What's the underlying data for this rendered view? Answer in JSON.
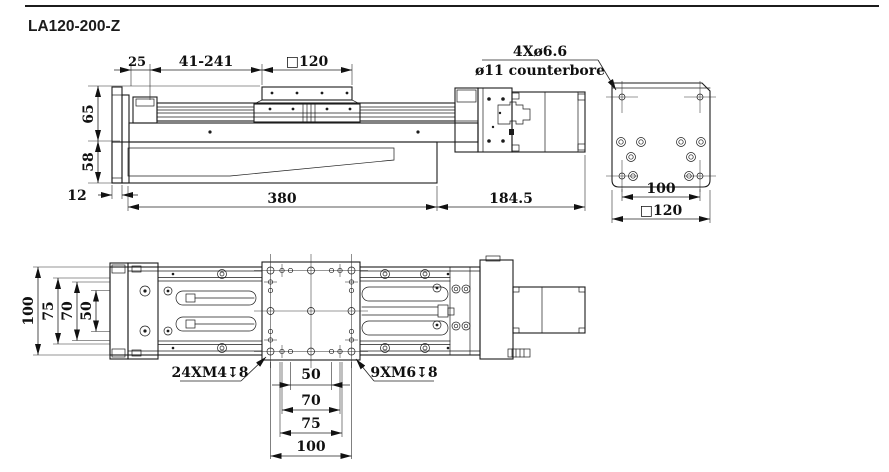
{
  "title": "LA120-200-Z",
  "front": {
    "d25": "25",
    "dstroke": "41-241",
    "dcarriage": "□120",
    "d65": "65",
    "d58": "58",
    "d12": "12",
    "d380": "380",
    "d1845": "184.5",
    "callout1": "4Xø6.6",
    "callout2": "ø11 counterbore"
  },
  "end": {
    "d100": "100",
    "d120": "□120"
  },
  "plan": {
    "left100": "100",
    "left75": "75",
    "left70": "70",
    "left50": "50",
    "bot50": "50",
    "bot70": "70",
    "bot75": "75",
    "bot100": "100",
    "m4label": "24XM4↧8",
    "m6label": "9XM6↧8"
  }
}
